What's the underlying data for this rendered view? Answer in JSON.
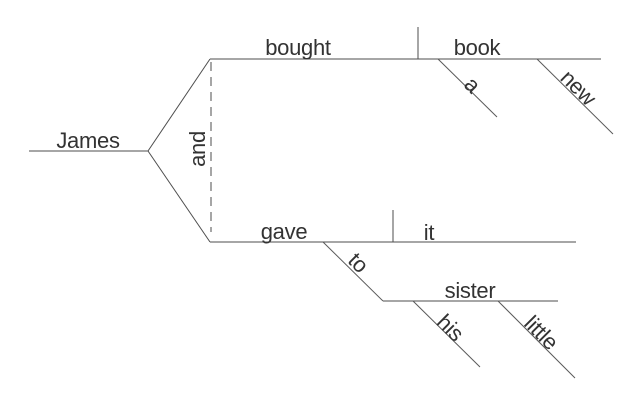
{
  "diagram": {
    "type": "reed-kellogg-sentence-diagram",
    "sentence": "James bought a new book and gave it to his little sister",
    "subject": {
      "word": "James"
    },
    "conjunction": {
      "word": "and"
    },
    "clause1": {
      "verb": "bought",
      "object": "book",
      "object_article": "a",
      "object_adjective": "new"
    },
    "clause2": {
      "verb": "gave",
      "object": "it",
      "preposition": "to",
      "prep_object": "sister",
      "prep_object_possessive": "his",
      "prep_object_adjective": "little"
    },
    "colors": {
      "line": "#4d4d4d",
      "text": "#333333",
      "background": "#ffffff"
    }
  }
}
